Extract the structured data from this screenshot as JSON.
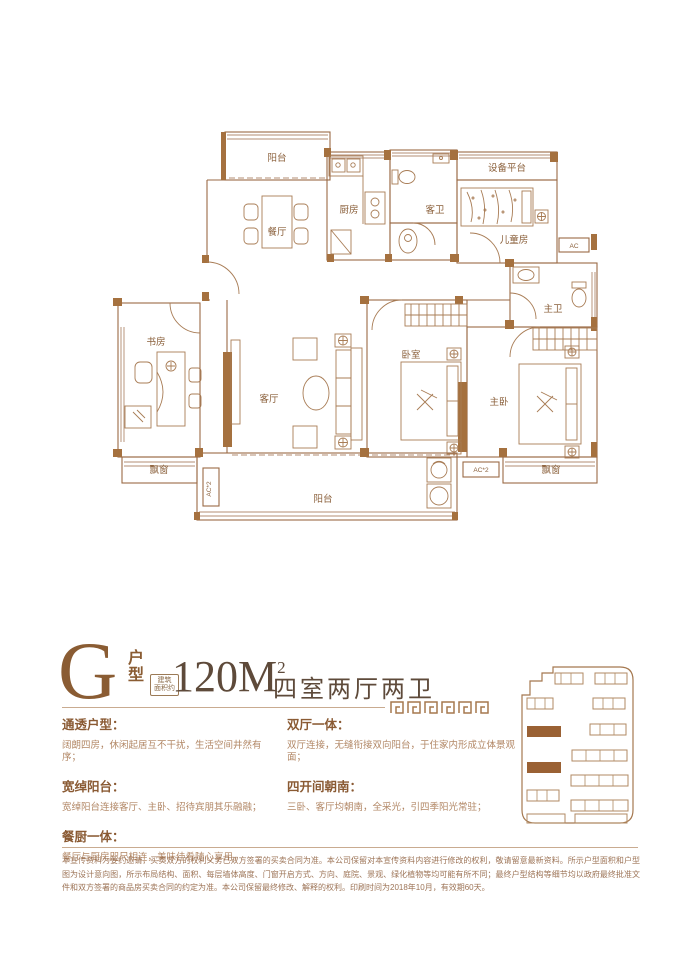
{
  "header": {
    "unit_letter": "G",
    "unit_type_char1": "户",
    "unit_type_char2": "型",
    "area_prefix_line1": "建筑",
    "area_prefix_line2": "面积约",
    "area_value": "120M",
    "area_sup": "2",
    "layout_text": "四室两厅两卫"
  },
  "floorplan": {
    "labels": [
      "阳台",
      "餐厅",
      "厨房",
      "客卫",
      "设备平台",
      "儿童房",
      "主卫",
      "书房",
      "客厅",
      "卧室",
      "主卧",
      "飘窗",
      "飘窗",
      "阳台"
    ],
    "ac": [
      "AC",
      "AC*2",
      "AC*2"
    ],
    "stroke_color": "#9a6a45",
    "wall_fill_color": "#a5713f",
    "label_color": "#8a5f3a"
  },
  "features": {
    "left": [
      {
        "title": "通透户型：",
        "desc": "阔朗四房，休闲起居互不干扰，生活空间井然有序；"
      },
      {
        "title": "宽绰阳台：",
        "desc": "宽绰阳台连接客厅、主卧、招待宾朋其乐融融；"
      },
      {
        "title": "餐厨一体：",
        "desc": "餐厅与厨房咫尺相连，美味佳肴随心享用。"
      }
    ],
    "right": [
      {
        "title": "双厅一体：",
        "desc": "双厅连接，无缝衔接双向阳台，于住家内形成立体景观面；"
      },
      {
        "title": "四开间朝南：",
        "desc": "三卧、客厅均朝南，全采光，引四季阳光常驻；"
      }
    ]
  },
  "disclaimer": "本宣传资料为要约邀请，买卖双方的权利义务已双方签署的买卖合同为准。本公司保留对本宣传资料内容进行修改的权利，敬请留意最新资料。所示户型面积和户型图为设计意向图，所示布局结构、面积、每层墙体高度、门窗开启方式、方向、庭院、景观、绿化植物等均可能有所不同；最终户型结构等细节均以政府最终批准文件和双方签署的商品房买卖合同的约定为准。本公司保留最终修改、解释的权利。印刷时间为2018年10月，有效期60天。",
  "colors": {
    "accent_brown": "#8a5c33",
    "dark_brown": "#5e4a3a",
    "body_brown": "#b28765",
    "divider": "#c9ab90"
  }
}
